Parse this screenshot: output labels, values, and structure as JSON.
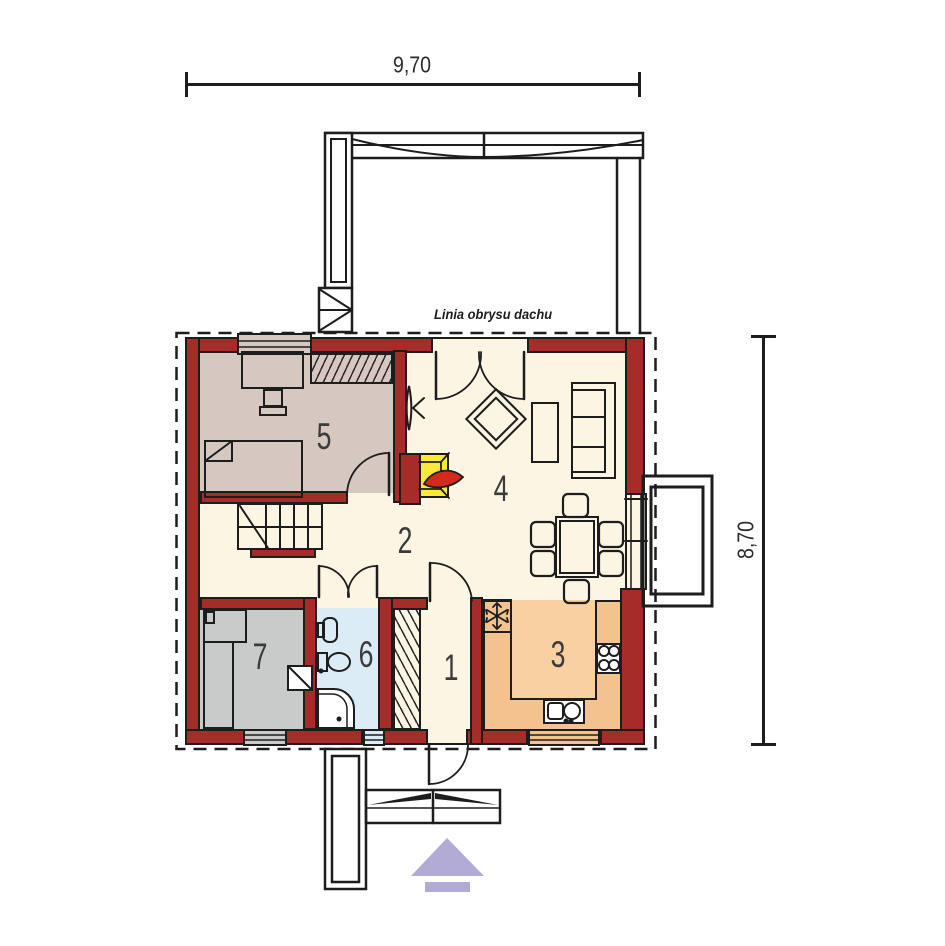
{
  "note_roof_outline": "Linia obrysu dachu",
  "dimensions": {
    "top": "9,70",
    "right": "8,70"
  },
  "rooms": [
    {
      "number": "1",
      "name": "vestibule",
      "floor_color": "#fcf5e4"
    },
    {
      "number": "2",
      "name": "hall-staircase",
      "floor_color": "#fcf5e4"
    },
    {
      "number": "3",
      "name": "kitchen",
      "floor_color": "#f3c28e"
    },
    {
      "number": "4",
      "name": "living-room",
      "floor_color": "#fcf5e4"
    },
    {
      "number": "5",
      "name": "bedroom",
      "floor_color": "#d6c8c0"
    },
    {
      "number": "6",
      "name": "bathroom",
      "floor_color": "#dcecf7"
    },
    {
      "number": "7",
      "name": "utility-room",
      "floor_color": "#c9cbca"
    }
  ],
  "colors": {
    "wall": "#a62c2a",
    "line": "#1d1d1d",
    "cream": "#fcf5e4",
    "taupe": "#d6c8c0",
    "gray": "#c9cbca",
    "blue": "#dcecf7",
    "orange": "#f3c28e",
    "orange_light": "#f8d0a1",
    "yellow": "#fce838",
    "flame": "#d42a1e",
    "arrow": "#b2abd5"
  },
  "icons": {
    "fridge": "snowflake-icon",
    "hob": "burner-rings-icon",
    "fireplace": "flame-icon",
    "entrance": "up-arrow-icon"
  }
}
